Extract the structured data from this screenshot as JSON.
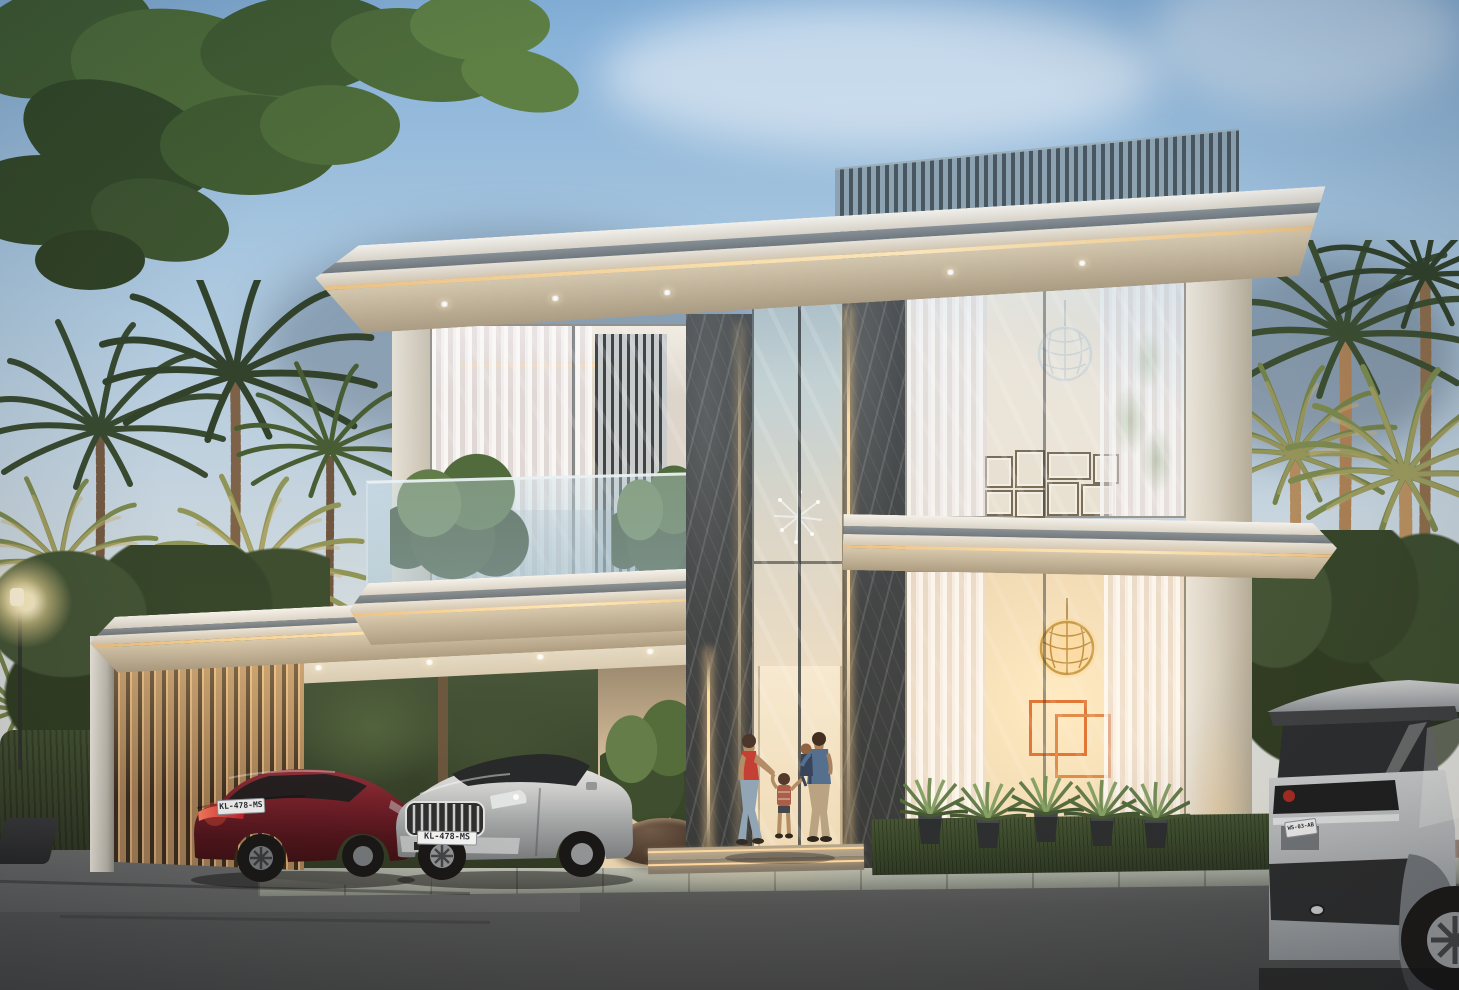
{
  "scene": {
    "type": "exterior architectural rendering",
    "time_of_day": "dusk",
    "subject": "Modern two-storey luxury villa with lit carport, double-height glass entrance, palm landscaping and a family arriving at the front door",
    "palette": {
      "sky_top": "#86b2da",
      "sky_horizon": "#e9e6df",
      "roof_white": "#f4f2ee",
      "fascia_gray": "#7e878d",
      "led_warm": "#ffdfa8",
      "soffit_cream": "#c9bda7",
      "marble_dark": "#41474b",
      "louver_blue": "#8ea4b2",
      "carport_wood": "#d8ae7c",
      "interior_glow": "#ffedc7",
      "art_orange": "#e0793a",
      "palm_green": "#3f5a33",
      "hedge_green": "#31452a",
      "grass_green": "#32452a",
      "asphalt": "#4a4e52",
      "curb_stone": "#aab2aa",
      "paver_pink": "#9a8a80",
      "car_red": "#6d1826",
      "car_silver": "#c6cacd",
      "suv_gray": "#b4bac0"
    },
    "elements": [
      "rooftop louver screen",
      "cove-lit roof slabs",
      "glass balustrade balcony with shrubs",
      "marble-clad entrance piers with LED strips",
      "gallery wall of framed pictures",
      "openwork sphere chandeliers",
      "orange geometric wall art",
      "potted agave plants",
      "backlit carport wood louvers",
      "street lamp",
      "fan palms",
      "overhanging tree branch"
    ]
  },
  "vehicles": {
    "sedan_red": {
      "color_name": "dark red",
      "plate": "KL-478-MS"
    },
    "sedan_silver": {
      "color_name": "silver",
      "plate": "KL-478-MS"
    },
    "suv_gray": {
      "color_name": "light gray",
      "plate": "WS-03-AB"
    }
  },
  "people": {
    "description": "Woman in a red top and jeans with a small child walking toward a man in a blue shirt holding a toddler at the entrance"
  }
}
